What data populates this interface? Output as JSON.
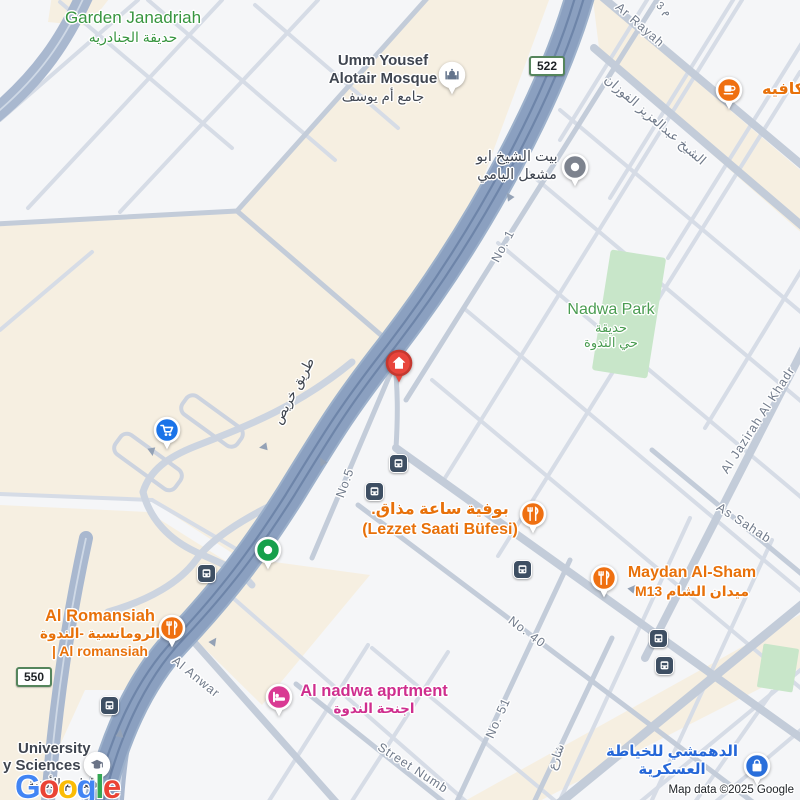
{
  "map": {
    "attribution": "Map data ©2025 Google",
    "logo_letters": [
      {
        "ch": "G",
        "color": "#4285F4"
      },
      {
        "ch": "o",
        "color": "#EA4335"
      },
      {
        "ch": "o",
        "color": "#FBBC05"
      },
      {
        "ch": "g",
        "color": "#4285F4"
      },
      {
        "ch": "l",
        "color": "#34A853"
      },
      {
        "ch": "e",
        "color": "#EA4335"
      }
    ]
  },
  "colors": {
    "highway": "#8ba0c0",
    "highway_stripe": "#6e85a9",
    "secondary": "#a9b8cf",
    "collector": "#c3ccd9",
    "minor": "#d6dce6",
    "beige": "#f6efe1",
    "park": "#c8e6c9",
    "green_label": "#37953f",
    "orange_label": "#e8710a",
    "pink_label": "#cf2e8e",
    "blue_label": "#2567d8",
    "dark_label": "#3f4550",
    "street_gray": "#707a8a",
    "bus_bg": "#3e4f63"
  },
  "badges": [
    {
      "id": "route-522",
      "text": "522",
      "x": 547,
      "y": 66
    },
    {
      "id": "route-550",
      "text": "550",
      "x": 34,
      "y": 677
    }
  ],
  "street_labels": [
    {
      "text": "Ar Rayah",
      "x": 640,
      "y": 25,
      "rot": 41
    },
    {
      "text": "م 3",
      "x": 664,
      "y": 9,
      "rot": 41,
      "size": 11
    },
    {
      "text": "الشيخ عبدالعزيز الفوزان",
      "x": 655,
      "y": 120,
      "rot": 41,
      "size": 13
    },
    {
      "text": "طريق خريص",
      "x": 294,
      "y": 391,
      "rot": -62,
      "size": 13.5,
      "color": "#3d434d"
    },
    {
      "text": "No. 1",
      "x": 503,
      "y": 246,
      "rot": -62
    },
    {
      "text": "No.5",
      "x": 345,
      "y": 483,
      "rot": -70
    },
    {
      "text": "No. 40",
      "x": 527,
      "y": 632,
      "rot": 37
    },
    {
      "text": "No. 51",
      "x": 498,
      "y": 718,
      "rot": -66
    },
    {
      "text": "Street Numb",
      "x": 413,
      "y": 768,
      "rot": 33
    },
    {
      "text": "Al Anwar",
      "x": 196,
      "y": 677,
      "rot": 39
    },
    {
      "text": "Al Jazirah Al Khadr",
      "x": 758,
      "y": 420,
      "rot": -57
    },
    {
      "text": "As Sahab",
      "x": 744,
      "y": 523,
      "rot": 33
    },
    {
      "text": "شارع",
      "x": 556,
      "y": 757,
      "rot": -70,
      "size": 12
    }
  ],
  "poi_labels": [
    {
      "id": "garden-janadriah-label",
      "x": 133,
      "y": 8,
      "align": "center",
      "color": "#37953f",
      "lines": [
        {
          "text": "Garden Janadriah",
          "size": 17,
          "weight": 500
        },
        {
          "text": "حديقة الجنادريه",
          "size": 14,
          "weight": 400
        }
      ]
    },
    {
      "id": "umm-yousef-mosque-label",
      "x": 383,
      "y": 52,
      "align": "center",
      "color": "#3f4550",
      "lines": [
        {
          "text": "Umm Yousef",
          "size": 15,
          "weight": 600
        },
        {
          "text": "Alotair Mosque",
          "size": 15,
          "weight": 600
        },
        {
          "text": "جامع أم يوسف",
          "size": 13.5,
          "weight": 400
        }
      ]
    },
    {
      "id": "cafe-label",
      "x": 762,
      "y": 80,
      "align": "left",
      "color": "#e8710a",
      "lines": [
        {
          "text": "ن كافيه",
          "size": 16,
          "weight": 700
        }
      ]
    },
    {
      "id": "sheikh-house-label",
      "x": 517,
      "y": 149,
      "align": "center",
      "color": "#3f4550",
      "lines": [
        {
          "text": "بيت الشيخ ابو",
          "size": 14.5,
          "weight": 500
        },
        {
          "text": "مشعل اليامي",
          "size": 14.5,
          "weight": 500
        }
      ]
    },
    {
      "id": "nadwa-park-label",
      "x": 611,
      "y": 300,
      "align": "center",
      "color": "#4a9c51",
      "lines": [
        {
          "text": "Nadwa Park",
          "size": 16,
          "weight": 500
        },
        {
          "text": "حديقة",
          "size": 13,
          "weight": 400
        },
        {
          "text": "حي الندوة",
          "size": 13,
          "weight": 400
        }
      ]
    },
    {
      "id": "lezzet-label",
      "x": 440,
      "y": 500,
      "align": "center",
      "color": "#e8710a",
      "lines": [
        {
          "text": "بوفية ساعة مذاق.",
          "size": 16,
          "weight": 700
        },
        {
          "text": "(Lezzet Saati Büfesi)",
          "size": 16,
          "weight": 700
        }
      ]
    },
    {
      "id": "maydan-label",
      "x": 692,
      "y": 563,
      "align": "center",
      "color": "#e8710a",
      "lines": [
        {
          "text": "Maydan Al-Sham",
          "size": 16,
          "weight": 700
        },
        {
          "text": "ميدان الشام M13",
          "size": 14,
          "weight": 600
        }
      ]
    },
    {
      "id": "romansiah-label",
      "x": 100,
      "y": 606,
      "align": "center",
      "color": "#e8710a",
      "lines": [
        {
          "text": "Al Romansiah",
          "size": 16.5,
          "weight": 700
        },
        {
          "text": "الرومانسية -الندوة",
          "size": 13.5,
          "weight": 600
        },
        {
          "text": "| Al romansiah",
          "size": 14,
          "weight": 600
        }
      ]
    },
    {
      "id": "nadwa-apartment-label",
      "x": 374,
      "y": 681,
      "align": "center",
      "color": "#cf2e8e",
      "lines": [
        {
          "text": "Al nadwa aprtment",
          "size": 16.5,
          "weight": 700
        },
        {
          "text": "اجنحة الندوة",
          "size": 13.5,
          "weight": 600
        }
      ]
    },
    {
      "id": "dahmashi-label",
      "x": 672,
      "y": 743,
      "align": "center",
      "color": "#2567d8",
      "lines": [
        {
          "text": "الدهمشي للخياطة",
          "size": 15,
          "weight": 700
        },
        {
          "text": "العسكرية",
          "size": 15,
          "weight": 700
        }
      ]
    },
    {
      "id": "university-label-1",
      "x": 18,
      "y": 740,
      "align": "left",
      "color": "#3f4550",
      "lines": [
        {
          "text": "University",
          "size": 15,
          "weight": 600
        }
      ]
    },
    {
      "id": "university-label-2",
      "x": 3,
      "y": 757,
      "align": "left",
      "color": "#3f4550",
      "lines": [
        {
          "text": "y Sciences",
          "size": 15,
          "weight": 600
        }
      ]
    },
    {
      "id": "university-label-ar",
      "x": 28,
      "y": 776,
      "align": "left",
      "color": "#3f4550",
      "lines": [
        {
          "text": "للعلوم الأمنية",
          "size": 13,
          "weight": 400
        }
      ]
    }
  ],
  "markers": [
    {
      "id": "mosque-pin",
      "type": "mosque",
      "x": 452,
      "y": 75,
      "color": "#ffffff",
      "glyph": "#64748c"
    },
    {
      "id": "cafe-pin",
      "type": "cafe",
      "x": 729,
      "y": 90,
      "color": "#ef7011",
      "glyph": "#ffffff"
    },
    {
      "id": "sheikh-house-pin",
      "type": "dot",
      "x": 575,
      "y": 167,
      "color": "#7d838e",
      "glyph": "#ffffff"
    },
    {
      "id": "home-pin",
      "type": "home",
      "x": 399,
      "y": 363,
      "color": "#e8453c",
      "glyph": "#ffffff"
    },
    {
      "id": "shopping-cart-pin",
      "type": "cart",
      "x": 167,
      "y": 430,
      "color": "#1a73e8",
      "glyph": "#ffffff"
    },
    {
      "id": "green-dot-pin",
      "type": "dot",
      "x": 268,
      "y": 550,
      "color": "#17a04b",
      "glyph": "#ffffff"
    },
    {
      "id": "lezzet-pin",
      "type": "restaurant",
      "x": 533,
      "y": 514,
      "color": "#ef7011",
      "glyph": "#ffffff"
    },
    {
      "id": "maydan-pin",
      "type": "restaurant",
      "x": 604,
      "y": 578,
      "color": "#ef7011",
      "glyph": "#ffffff"
    },
    {
      "id": "romansiah-pin",
      "type": "restaurant",
      "x": 172,
      "y": 628,
      "color": "#ef7011",
      "glyph": "#ffffff"
    },
    {
      "id": "apartment-pin",
      "type": "bed",
      "x": 279,
      "y": 697,
      "color": "#d93a93",
      "glyph": "#ffffff"
    },
    {
      "id": "dahmashi-pin",
      "type": "bag",
      "x": 757,
      "y": 766,
      "color": "#2a6fdb",
      "glyph": "#ffffff"
    },
    {
      "id": "university-pin",
      "type": "grad",
      "x": 97,
      "y": 765,
      "color": "#ffffff",
      "glyph": "#6b7487"
    }
  ],
  "bus_stops": [
    [
      397,
      462
    ],
    [
      373,
      490
    ],
    [
      521,
      568
    ],
    [
      657,
      637
    ],
    [
      663,
      664
    ],
    [
      205,
      572
    ],
    [
      108,
      704
    ]
  ]
}
